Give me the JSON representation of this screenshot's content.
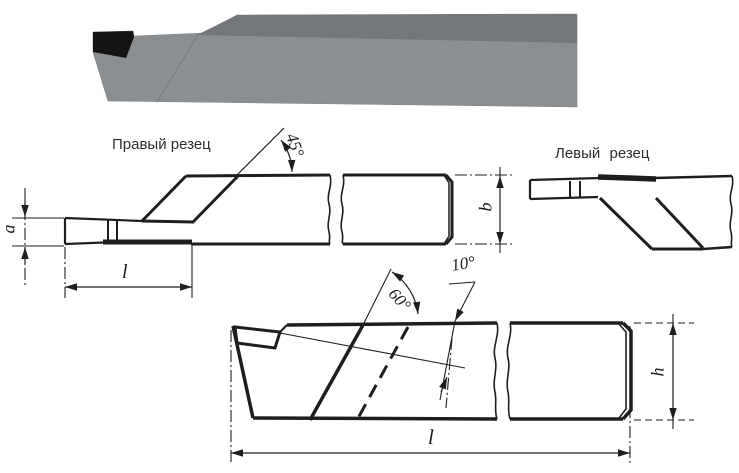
{
  "labels": {
    "right_cutter": "Правый резец",
    "left_cutter": "Левый резец"
  },
  "angles": {
    "main_45": "45°",
    "notch_60": "60°",
    "incline_10": "10°"
  },
  "dimensions": {
    "blade_height_a": "a",
    "shank_width_b": "b",
    "blade_length_l": "l",
    "shank_height_h": "h",
    "overall_length_l": "l"
  },
  "colors": {
    "background": "#ffffff",
    "line": "#1e1e1c",
    "tool_body_gray": "#8c8f92",
    "tool_top_face_gray": "#73767a",
    "tool_tip_black": "#141414"
  }
}
